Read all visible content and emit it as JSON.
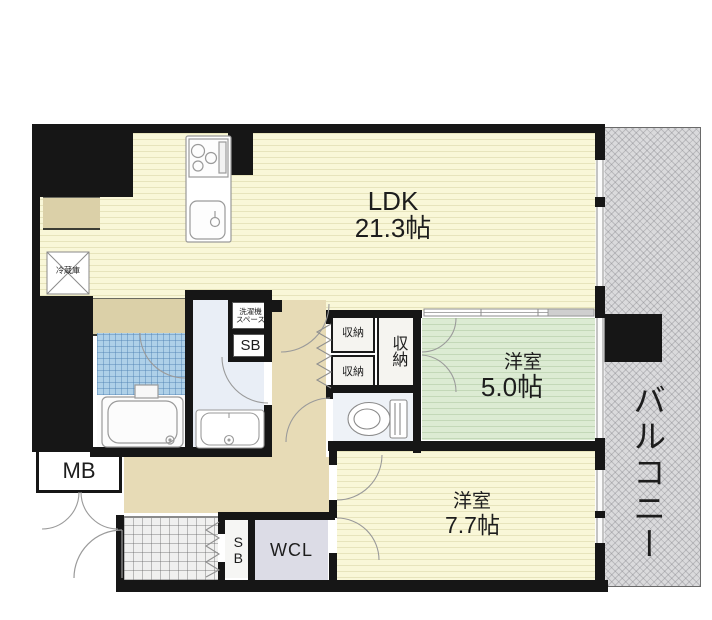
{
  "plan_type": "apartment-floor-plan",
  "colors": {
    "wall": "#161616",
    "ldk_floor": "#f9f7d8",
    "western5_floor": "#dcebd3",
    "hallway_floor": "#e7dbb6",
    "bath_tile": "#aed0e8",
    "washroom_floor": "#e9eef6",
    "wcl_floor": "#dcdce6",
    "balcony": "#dadadc"
  },
  "rooms": {
    "ldk": {
      "name": "LDK",
      "size": "21.3帖"
    },
    "western5": {
      "name": "洋室",
      "size": "5.0帖"
    },
    "western77": {
      "name": "洋室",
      "size": "7.7帖"
    },
    "balcony": {
      "name": "バルコニー"
    }
  },
  "labels": {
    "mb": "MB",
    "wcl": "WCL",
    "sb": "SB",
    "sb_entrance": "SB",
    "storage_a": "収納",
    "storage_b": "収納",
    "storage_c": "収納",
    "refrigerator": "冷蔵庫",
    "laundry_line1": "洗濯機",
    "laundry_line2": "スペース"
  }
}
